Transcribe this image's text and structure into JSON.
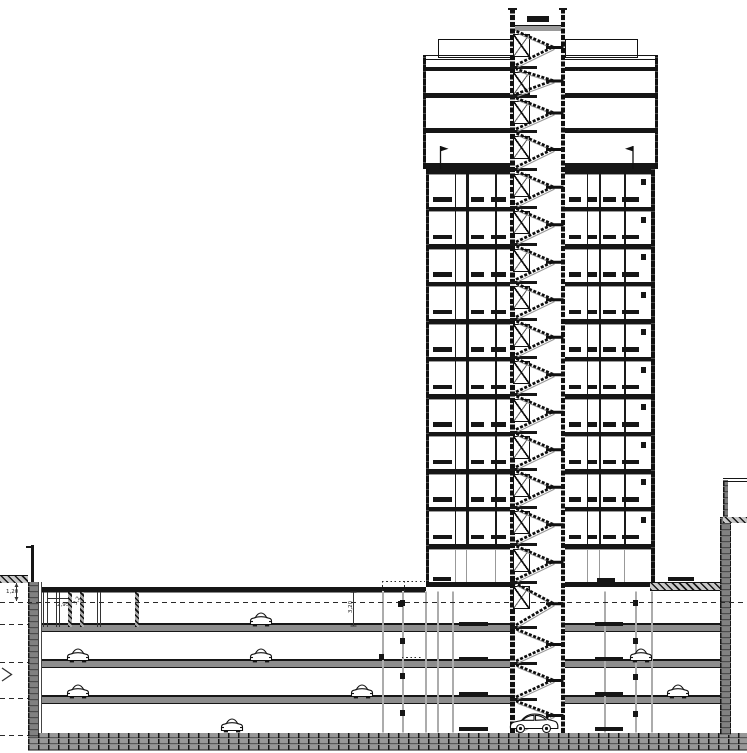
{
  "drawing": {
    "kind": "building-cross-section",
    "width": 747,
    "height": 753,
    "colors": {
      "ink": "#161616",
      "gray": "#555",
      "lightgray": "#9a9a9a",
      "white": "#ffffff"
    }
  },
  "labels": {
    "dim_ground": "1,20",
    "height_a": "2,95",
    "height_b": "3,2",
    "height_c": "3,20"
  },
  "tower": {
    "left": 425.5,
    "right": 654.5,
    "upper_left": 422.5,
    "upper_right": 657.5,
    "shaft_left": 510,
    "shaft_right": 565,
    "roof_parapet_y": 55,
    "typical_top_y": 169,
    "ground_slab_y": 581.5,
    "typical_floor_count": 11,
    "upper_slabs": [
      {
        "y": 55,
        "h": 1
      },
      {
        "y": 58.5,
        "h": 1
      },
      {
        "y": 66.5,
        "h": 4.5
      },
      {
        "y": 93,
        "h": 5
      },
      {
        "y": 128,
        "h": 5
      },
      {
        "y": 163,
        "h": 6
      }
    ],
    "penthouse": {
      "y": 38.5,
      "h": 17,
      "left_x": 437.5,
      "right_end": 635.5
    },
    "roof_hatch_rect": {
      "x": 527,
      "y": 15.5,
      "w": 22,
      "h": 6.5
    },
    "shaft_top_y": 8,
    "shaft_roof_slab": {
      "y": 25,
      "h": 4.5
    },
    "left_partitions": [
      [
        455,
        1.2
      ],
      [
        466,
        2.6
      ],
      [
        495,
        1.6
      ]
    ],
    "right_partitions": [
      [
        587,
        1.2
      ],
      [
        598.5,
        2.6
      ],
      [
        624,
        1.6
      ]
    ],
    "left_windows": [
      [
        433,
        18.5
      ],
      [
        470.5,
        13
      ],
      [
        490.5,
        15.5
      ]
    ],
    "right_windows": [
      [
        569,
        12
      ],
      [
        587,
        10
      ],
      [
        602.5,
        13.5
      ],
      [
        621.5,
        17.5
      ]
    ],
    "right_mid_square_x": 640.5,
    "flags": [
      {
        "x": 440.5,
        "dir": 1
      },
      {
        "x": 633,
        "dir": -1
      }
    ]
  },
  "shaft_landings": [
    29,
    67,
    96,
    131,
    169,
    206.5,
    244,
    281.5,
    319,
    356.5,
    394,
    431.5,
    469,
    506.5,
    544,
    581.5,
    627,
    663,
    699,
    733
  ],
  "door_box_max_landing": 581.5,
  "parking": {
    "top_slab_outside_y": 587,
    "slabs": [
      627,
      663,
      699
    ],
    "foundation_y": 733,
    "interior_left": 42,
    "interior_right": 720,
    "left_wall": {
      "x": 28,
      "w": 10,
      "top": 582
    },
    "left_ground_strip": {
      "x": 0,
      "w": 28,
      "y": 575,
      "h": 7
    },
    "left_post": {
      "x": 30.5,
      "w": 3.5,
      "top": 545
    },
    "right_wall": {
      "x": 719.5,
      "w": 11.5,
      "top": 517
    },
    "right_upper_wall": {
      "x": 723,
      "w": 4.5,
      "top": 480
    },
    "right_roof_band": {
      "x": 723,
      "y": 517,
      "w": 24,
      "h": 6
    },
    "right_parapet_lines": [
      478,
      480.5
    ],
    "ramp": {
      "x": 650,
      "y": 582,
      "w": 70,
      "h": 7
    },
    "datum_dash_y": 601.5,
    "left_dash_stub_ys": [
      623.5,
      662,
      698,
      734.5
    ],
    "top_level_walls": [
      [
        43,
        1
      ],
      [
        47,
        1
      ],
      [
        56,
        1
      ],
      [
        59,
        1
      ],
      [
        68,
        4
      ],
      [
        80,
        4
      ],
      [
        97,
        1
      ],
      [
        100,
        1
      ],
      [
        134.5,
        4
      ]
    ],
    "wall_finish_lines": [
      37.5,
      41
    ],
    "columns": [
      381.5,
      402,
      424.5,
      437,
      451.5,
      604,
      635,
      650.5
    ],
    "column_squares": {
      "x399": [
        599.5,
        637.5,
        673,
        709.5
      ],
      "x632": [
        599.5,
        638,
        674,
        710.5
      ],
      "x379": [
        653.5
      ]
    },
    "floor_dashes": {
      "xs": [
        [
          458.5,
          29
        ],
        [
          595,
          28
        ]
      ],
      "ys": [
        621.5,
        656.5,
        691.5,
        726.5
      ]
    },
    "ground_dashes": [
      [
        433,
        18,
        576.5
      ],
      [
        597,
        17.5,
        577.5
      ],
      [
        667.5,
        26,
        577
      ]
    ],
    "canopy": {
      "x1": 382,
      "x2": 425,
      "y": 580.5,
      "drop_to": 591,
      "mid_x": 403.5
    },
    "dotted_stub": {
      "x1": 402,
      "x2": 422,
      "y": 656.5
    },
    "canopy_square": {
      "x": 397.5,
      "y": 600.5,
      "w": 5,
      "h": 6
    },
    "chevron": {
      "points": [
        [
          2,
          668
        ],
        [
          11.5,
          674.5
        ],
        [
          2,
          681
        ]
      ]
    }
  },
  "cars": [
    {
      "type": "front",
      "x": 249,
      "base": 627
    },
    {
      "type": "front",
      "x": 66,
      "base": 663
    },
    {
      "type": "front",
      "x": 249,
      "base": 663
    },
    {
      "type": "front",
      "x": 629,
      "base": 663
    },
    {
      "type": "front",
      "x": 66,
      "base": 699
    },
    {
      "type": "front",
      "x": 350,
      "base": 699
    },
    {
      "type": "front",
      "x": 666,
      "base": 699
    },
    {
      "type": "front",
      "x": 220,
      "base": 733
    },
    {
      "type": "side",
      "x": 509,
      "base": 733
    }
  ],
  "dimensions": {
    "dim_120": {
      "x": 16.5,
      "y1": 583,
      "y2": 601,
      "label_x": 6,
      "label_y": 589
    },
    "dim_295": {
      "label_x": 57,
      "label_y": 602
    },
    "dim_32": {
      "label_x": 73,
      "label_y": 598,
      "rot": -60
    },
    "dim_320": {
      "x": 353.5,
      "y1": 592,
      "y2": 626,
      "label_x": 345,
      "label_y": 604,
      "rot": -90
    }
  }
}
